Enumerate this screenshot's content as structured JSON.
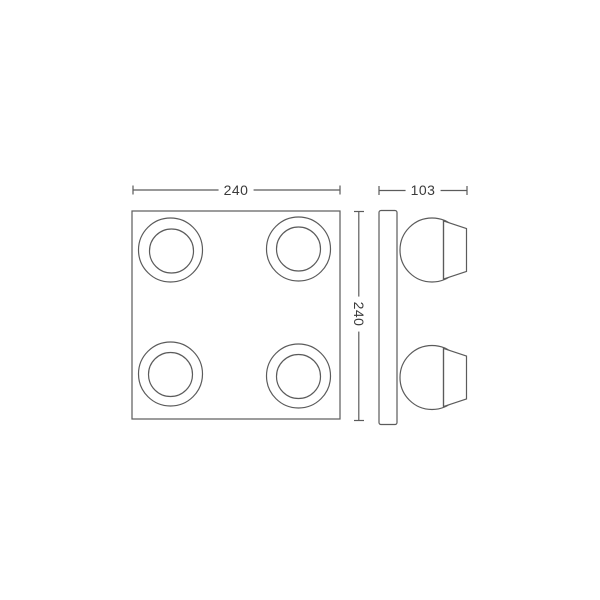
{
  "diagram": {
    "front_view": {
      "width_dim": "240",
      "height_dim": "240"
    },
    "side_view": {
      "depth_dim": "103"
    },
    "colors": {
      "line": "#5b5b5b",
      "text": "#3a3a3a",
      "background": "#ffffff"
    }
  }
}
